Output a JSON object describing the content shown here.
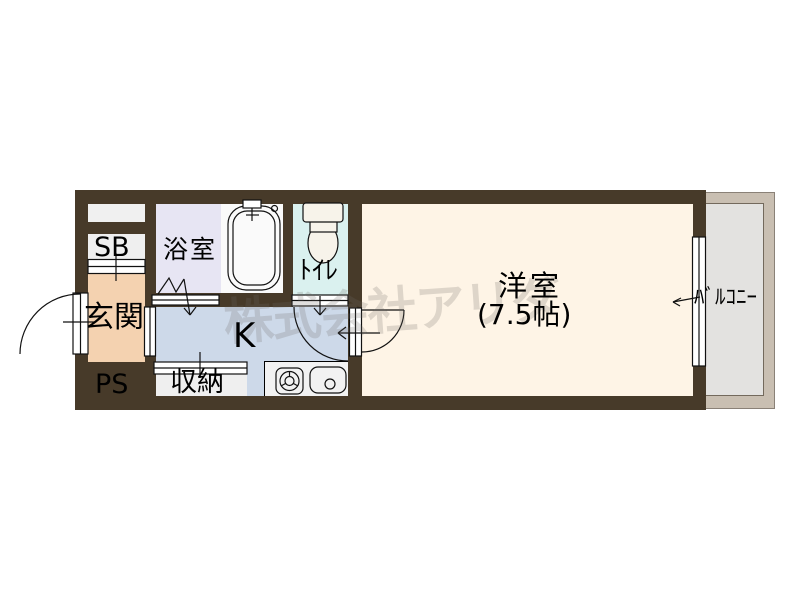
{
  "plan": {
    "type": "japanese-apartment-floor-plan",
    "watermark": "株式会社アリダ",
    "rooms": {
      "shoe_box": {
        "label": "SB"
      },
      "entrance": {
        "label": "玄関"
      },
      "pipe_space": {
        "label": "PS"
      },
      "bathroom": {
        "label": "浴室"
      },
      "toilet": {
        "label": "ﾄｲﾚ"
      },
      "kitchen": {
        "label": "K"
      },
      "closet": {
        "label": "収納"
      },
      "main_room": {
        "label": "洋室",
        "size": "(7.5帖)"
      },
      "balcony": {
        "label": "ﾊﾞﾙｺﾆｰ"
      }
    },
    "colors": {
      "wall": "#473a29",
      "entrance": "#f4d2b0",
      "bathroom": "#e7e5f3",
      "toilet": "#daf1ef",
      "kitchen": "#cdd9e9",
      "main_room": "#fef4e6",
      "storage_gray": "#efefef",
      "counter": "#f2f2f2",
      "balcony_floor": "#e3e2e0",
      "balcony_frame": "#c9bfb2",
      "tub_area": "#fafafa"
    }
  }
}
